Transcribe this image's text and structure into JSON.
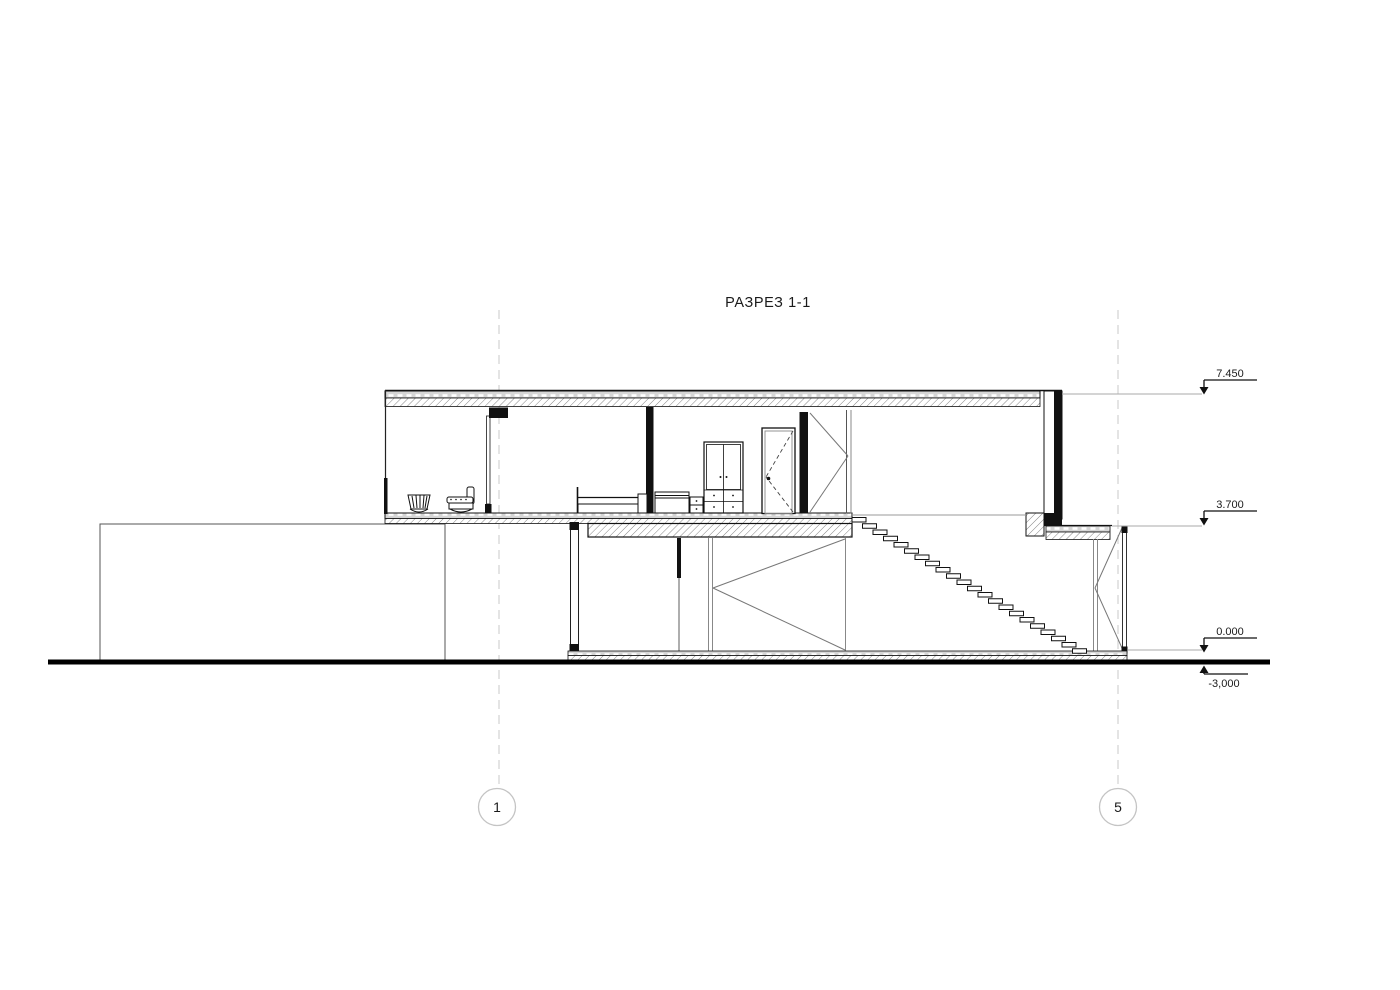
{
  "title": "РАЗРЕЗ 1-1",
  "colors": {
    "section_line": "#111111",
    "elevation_view_line": "#888888",
    "grid_line": "#c9c9c9",
    "ground_line": "#000000",
    "background": "#ffffff"
  },
  "drawing": {
    "type": "architectural-section",
    "grid_markers": [
      {
        "label": "1"
      },
      {
        "label": "5"
      }
    ],
    "elevation_markers": [
      {
        "label": "7.450"
      },
      {
        "label": "3.700"
      },
      {
        "label": "0.000"
      },
      {
        "label": "-3,000"
      }
    ],
    "stairs": {
      "count": 22,
      "x0": 852,
      "y0": 517.5,
      "dx": 10.5,
      "dy": 6.25,
      "tread_w": 14,
      "tread_h": 4.5
    }
  }
}
